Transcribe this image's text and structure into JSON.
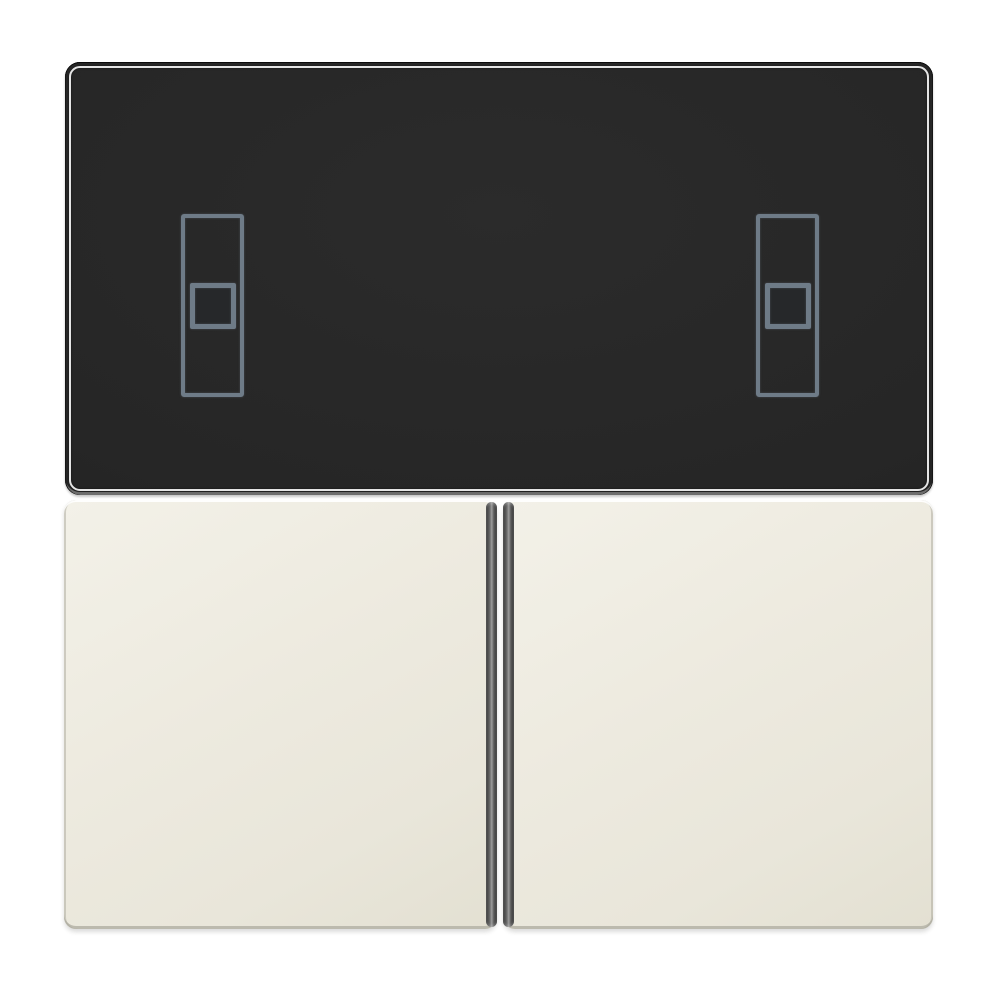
{
  "scene": {
    "label": "Product photo of a two-gang flush-mount switch cover set",
    "description": "Square black control panel with two grey blind-control rocker pictograms, mounted above a pair of ivory push-button rockers separated by a narrow vertical groove, on a plain white background",
    "text_content": "none (no visible text, labels or numbers in the image)"
  },
  "panel": {
    "label": "Black glass control panel with thin bright edge-reflection outline and metallic bottom rim",
    "pictogram_count": 2,
    "pictograms": [
      {
        "position": "left",
        "label": "Vertical rocker pictogram: tall rectangle outline with centered square button outline",
        "outline_color": "#6e7b87"
      },
      {
        "position": "right",
        "label": "Vertical rocker pictogram: tall rectangle outline with centered square button outline",
        "outline_color": "#6e7b87"
      }
    ]
  },
  "buttons": {
    "count": 2,
    "left": {
      "label": "Left ivory rocker push-button with dark inner side face"
    },
    "right": {
      "label": "Right ivory rocker push-button with dark inner side face"
    }
  },
  "colors": {
    "background": "#ffffff",
    "panel_surface": "#262626",
    "panel_edge_highlight": "#f4f4f4",
    "panel_bottom_rim": "#6e6e6e",
    "pictogram_outline": "#6e7b87",
    "key_surface": "#edeadf",
    "key_surface_light": "#f3f1e8",
    "key_surface_dark": "#e3e0d2",
    "key_edge_shadow": "#bcbaae",
    "groove_dark": "#303030",
    "groove_light": "#9c9c9c"
  }
}
